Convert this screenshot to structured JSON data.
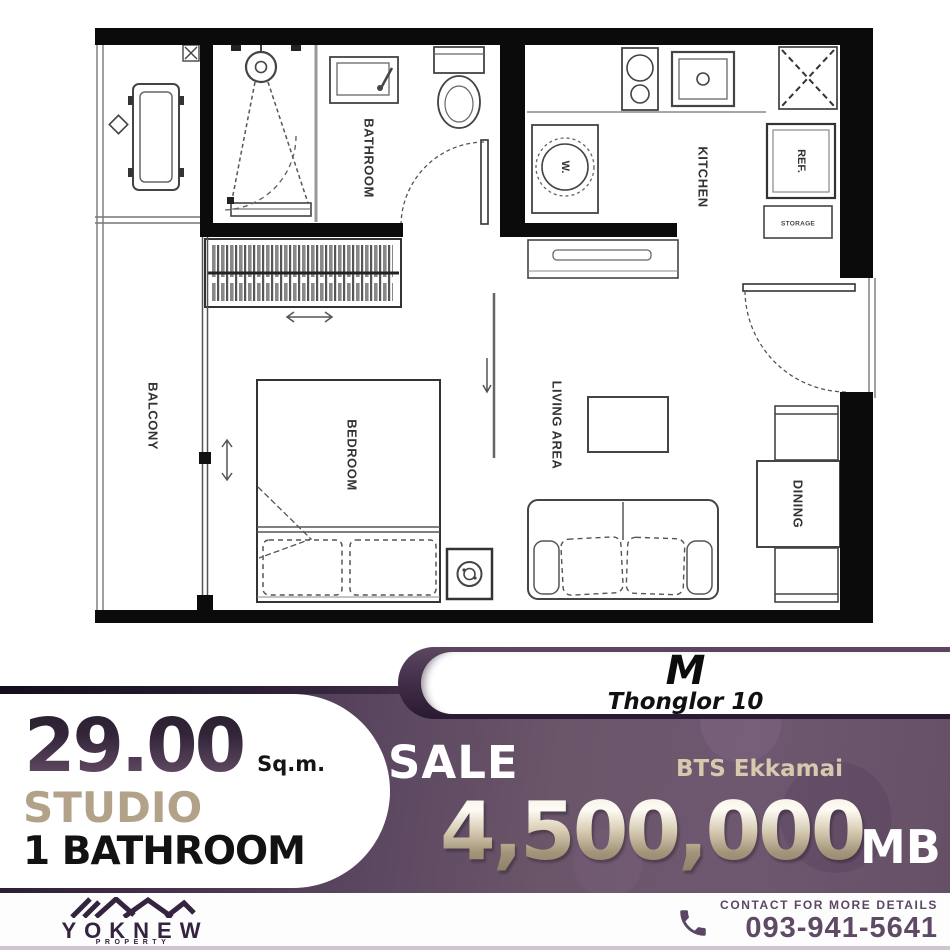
{
  "floorplan": {
    "labels": {
      "balcony": "BALCONY",
      "bathroom": "BATHROOM",
      "kitchen": "KITCHEN",
      "bedroom": "BEDROOM",
      "living_area": "LIVING AREA",
      "dining": "DINING",
      "washer": "W.",
      "refrigerator": "REF.",
      "storage": "STORAGE"
    }
  },
  "unit_card": {
    "model": "M",
    "project": "Thonglor 10"
  },
  "details": {
    "area_value": "29.00",
    "area_unit": "Sq.m.",
    "unit_type": "STUDIO",
    "bathroom": "1 BATHROOM"
  },
  "offer": {
    "listing_type": "SALE",
    "station": "BTS Ekkamai",
    "price": "4,500,000",
    "currency_unit": "MB"
  },
  "footer": {
    "brand": "YOKNEW",
    "brand_subtitle": "PROPERTY",
    "contact_label": "CONTACT FOR MORE DETAILS",
    "phone": "093-941-5641"
  },
  "colors": {
    "band_purple": "#68536a",
    "band_dark": "#2a1c33",
    "accent_tan": "#b2a38c",
    "price_gold": "#cfc4ac",
    "contact_purple": "#5c4763",
    "plan_wall": "#0b0b0b"
  }
}
